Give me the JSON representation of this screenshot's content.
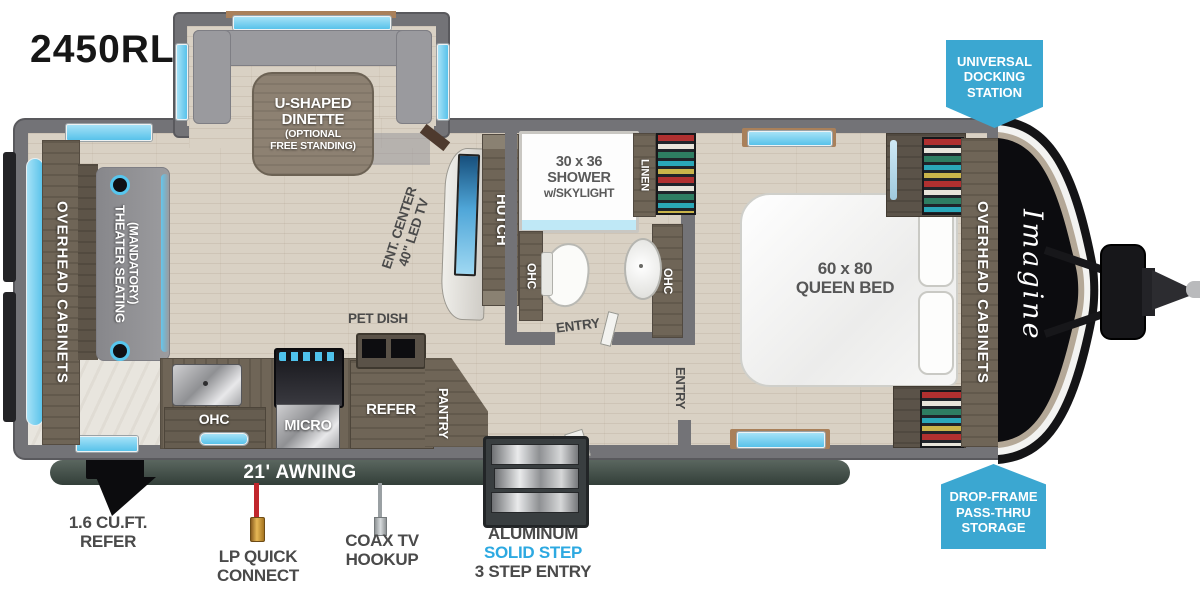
{
  "title": {
    "model": "2450RL"
  },
  "colors": {
    "badge_blue": "#3ba7d1",
    "window_blue": "#58c2ea",
    "awning_dark": "#3d4a44",
    "lp_red": "#c1272d",
    "step_blue": "#2da9e1",
    "label_gray": "#4a4a4a"
  },
  "callouts": {
    "docking": {
      "line1": "UNIVERSAL",
      "line2": "DOCKING",
      "line3": "STATION"
    },
    "drop_frame": {
      "line1": "DROP-FRAME",
      "line2": "PASS-THRU",
      "line3": "STORAGE"
    },
    "ext_refer": {
      "line1": "1.6 CU.FT.",
      "line2": "REFER"
    },
    "lp": {
      "line1": "LP QUICK",
      "line2": "CONNECT"
    },
    "coax": {
      "line1": "COAX TV",
      "line2": "HOOKUP"
    },
    "steps": {
      "line1": "ALUMINUM",
      "line2": "SOLID STEP",
      "line3": "3 STEP ENTRY"
    },
    "awning": "21' AWNING"
  },
  "rooms": {
    "dinette": {
      "line1": "U-SHAPED",
      "line2": "DINETTE",
      "line3": "(OPTIONAL",
      "line4": "FREE STANDING)"
    },
    "living": {
      "overhead": "OVERHEAD CABINETS",
      "theater1": "THEATER SEATING",
      "theater2": "(MANDATORY)",
      "ent1": "ENT. CENTER",
      "ent2": "40\" LED TV",
      "hutch": "HUTCH"
    },
    "kitchen": {
      "pet_dish": "PET DISH",
      "ohc": "OHC",
      "micro": "MICRO",
      "refer": "REFER",
      "pantry": "PANTRY"
    },
    "bath": {
      "shower1": "30 x 36",
      "shower2": "SHOWER",
      "shower3": "w/SKYLIGHT",
      "linen": "LINEN",
      "ohc_left": "OHC",
      "ohc_right": "OHC",
      "entry": "ENTRY"
    },
    "bedroom": {
      "bed1": "60 x 80",
      "bed2": "QUEEN BED",
      "entry": "ENTRY",
      "overhead": "OVERHEAD CABINETS",
      "brand": "Imagine"
    }
  }
}
